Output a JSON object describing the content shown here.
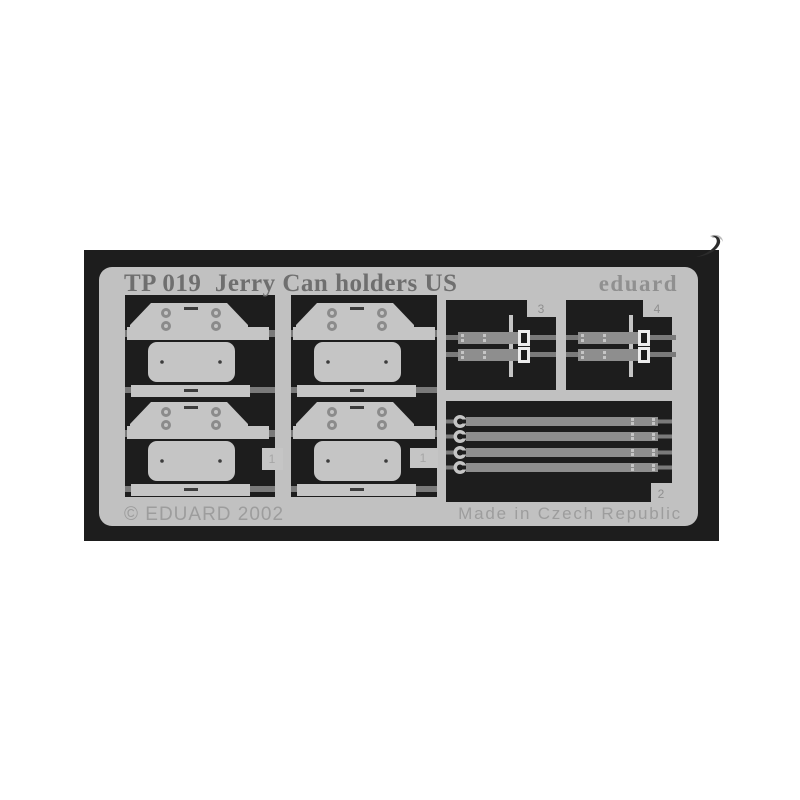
{
  "colors": {
    "page_bg": "#ffffff",
    "backing": "#1d1d1d",
    "frame": "#c1c1c1",
    "part": "#c5c5c5",
    "runner": "#7a7a7a",
    "strap": "#8e8e8e",
    "rivet": "#8b8b8b",
    "etch": "#3c3c3c",
    "buckle": "#ececec",
    "title_text": "#6f6f6f",
    "brand_text": "#909090",
    "engraved_text": "#9d9d9d",
    "number_text": "#8f8f8f",
    "number_faint_text": "#a6a6a6"
  },
  "sheet": {
    "title": "TP 019  Jerry Can holders US",
    "brand": "eduard",
    "copyright": "© EDUARD 2002",
    "made_in": "Made in Czech Republic",
    "labels": {
      "plate_tab_left": "1",
      "plate_tab_middle": "1",
      "long_straps_panel": "2",
      "short_straps_panel_left": "3",
      "short_straps_panel_right": "4"
    },
    "parts_visible": {
      "holder_plates": 4,
      "long_straps": 4,
      "short_strap_pairs": 2
    }
  }
}
